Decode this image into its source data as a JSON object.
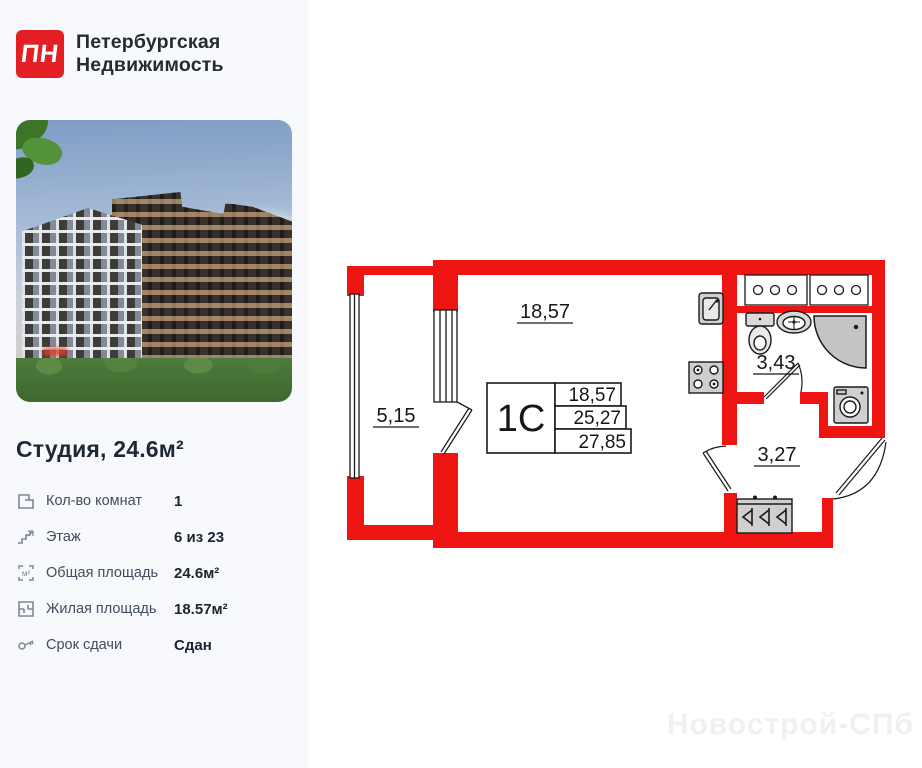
{
  "brand": {
    "logo_text": "ПН",
    "logo_color": "#e31e24",
    "name_line1": "Петербургская",
    "name_line2": "Недвижимость"
  },
  "listing": {
    "title": "Студия, 24.6м²"
  },
  "details": [
    {
      "icon": "rooms-icon",
      "label": "Кол-во комнат",
      "value": "1"
    },
    {
      "icon": "floor-icon",
      "label": "Этаж",
      "value": "6 из 23"
    },
    {
      "icon": "total-area-icon",
      "label": "Общая площадь",
      "value": "24.6м²"
    },
    {
      "icon": "living-area-icon",
      "label": "Жилая площадь",
      "value": "18.57м²"
    },
    {
      "icon": "key-icon",
      "label": "Срок сдачи",
      "value": "Сдан"
    }
  ],
  "floor_plan": {
    "wall_color": "#ee1411",
    "unit_label": "1С",
    "areas": {
      "living": "18,57",
      "total": "25,27",
      "total_with_balcony": "27,85"
    },
    "room_labels": {
      "main": "18,57",
      "balcony": "5,15",
      "bathroom": "3,43",
      "hallway": "3,27"
    }
  },
  "watermark": "Новострой-СПб"
}
